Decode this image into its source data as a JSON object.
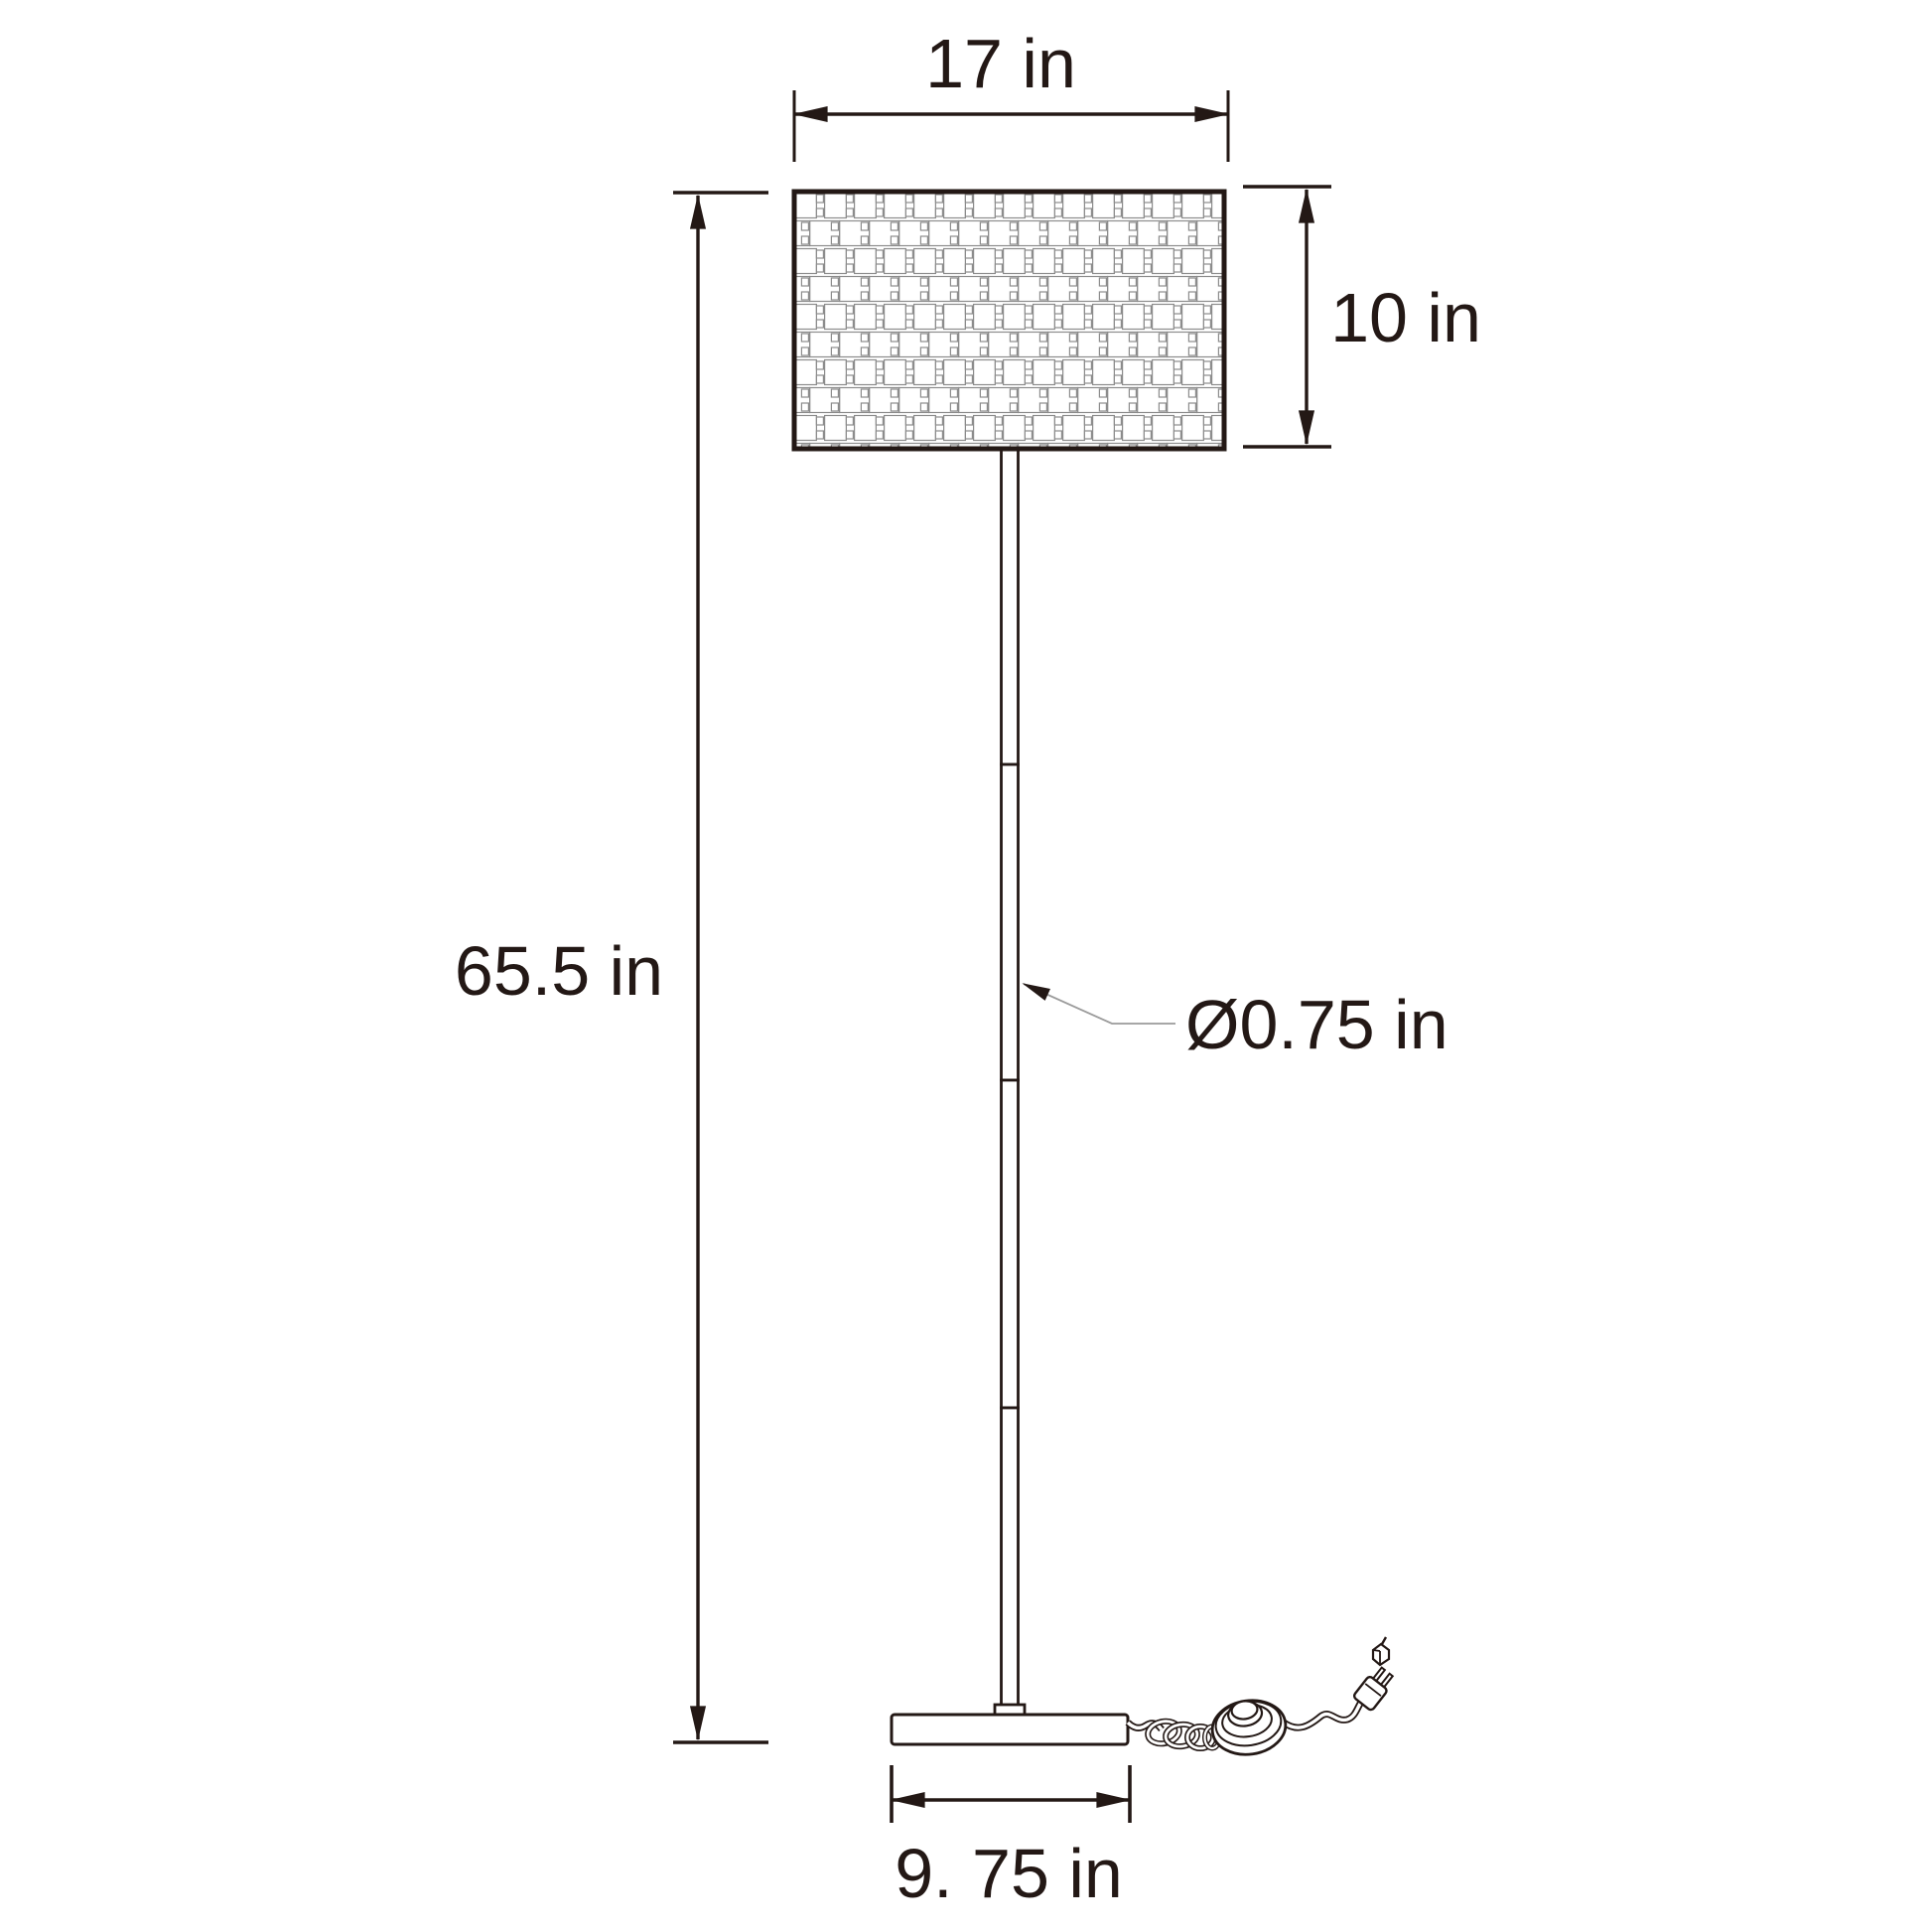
{
  "page": {
    "title": "Floor lamp dimension diagram",
    "background": "#ffffff"
  },
  "colors": {
    "line": "#231815",
    "text": "#231815",
    "leader_line": "#9b9b9b",
    "weave_grid": "#8c8c8c",
    "fill": "#ffffff"
  },
  "lamp": {
    "parts": {
      "shade": "basketweave-drum-shade",
      "pole": "four-segment-pole",
      "base": "flat-base",
      "foot_switch": "foot-pedal-switch",
      "power_cord": "coiled-power-cord",
      "plug": "two-prong-plug"
    }
  },
  "dimensions": {
    "shade_width": {
      "label": "17 in",
      "value": 17,
      "unit": "in"
    },
    "shade_height": {
      "label": "10 in",
      "value": 10,
      "unit": "in"
    },
    "lamp_height": {
      "label": "65.5 in",
      "value": 65.5,
      "unit": "in"
    },
    "pole_diameter": {
      "label": "Ø0.75 in",
      "value": 0.75,
      "unit": "in"
    },
    "base_width": {
      "label": "9. 75 in",
      "value": 9.75,
      "unit": "in"
    }
  }
}
